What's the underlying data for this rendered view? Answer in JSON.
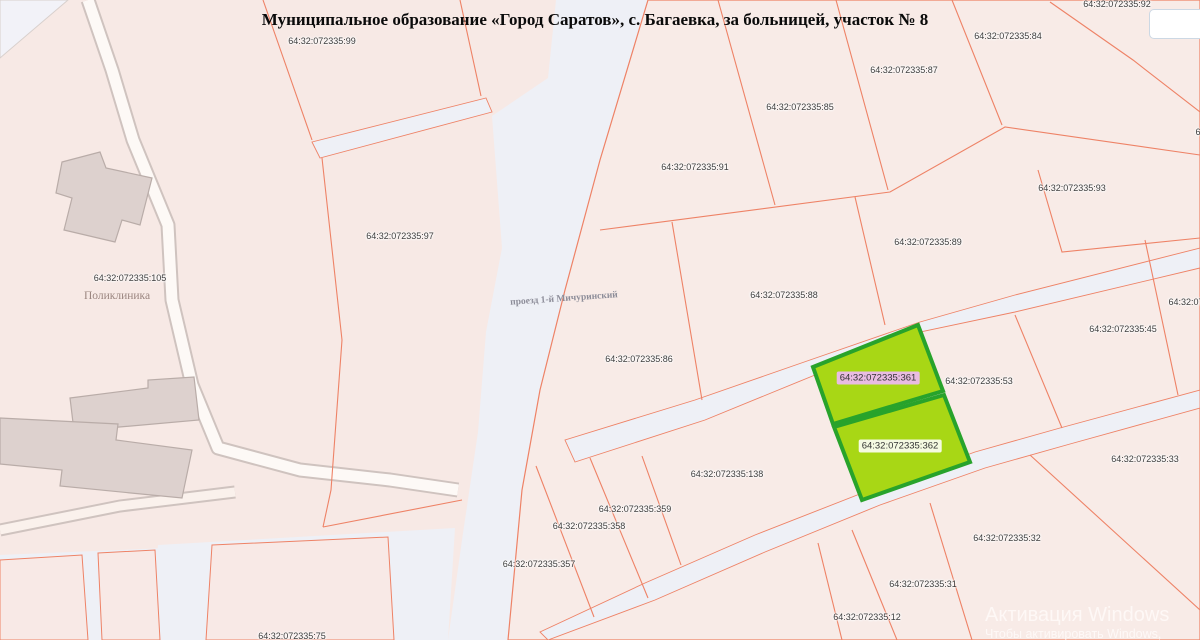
{
  "title": "Муниципальное образование «Город Саратов», с. Багаевка, за больницей, участок № 8",
  "map": {
    "parcel_labels": [
      {
        "text": "64:32:072335:92",
        "x": 1117,
        "y": 5
      },
      {
        "text": "64:32:072335:84",
        "x": 1008,
        "y": 37
      },
      {
        "text": "64:32:072335:87",
        "x": 904,
        "y": 71
      },
      {
        "text": "64:32:072335:85",
        "x": 800,
        "y": 108
      },
      {
        "text": "64:32:072335:91",
        "x": 695,
        "y": 168
      },
      {
        "text": "64:32:072335:93",
        "x": 1072,
        "y": 189
      },
      {
        "text": "64:32:072335:89",
        "x": 928,
        "y": 243
      },
      {
        "text": "64:32:072335:88",
        "x": 784,
        "y": 296
      },
      {
        "text": "64:32:072335:86",
        "x": 639,
        "y": 360
      },
      {
        "text": "64:32:072335:45",
        "x": 1123,
        "y": 330
      },
      {
        "text": "64:32:072335:53",
        "x": 979,
        "y": 382
      },
      {
        "text": "64:32:072335:33",
        "x": 1145,
        "y": 460
      },
      {
        "text": "64:32:072335:138",
        "x": 727,
        "y": 475
      },
      {
        "text": "64:32:072335:359",
        "x": 635,
        "y": 510
      },
      {
        "text": "64:32:072335:358",
        "x": 589,
        "y": 527
      },
      {
        "text": "64:32:072335:357",
        "x": 539,
        "y": 565
      },
      {
        "text": "64:32:072335:32",
        "x": 1007,
        "y": 539
      },
      {
        "text": "64:32:072335:31",
        "x": 923,
        "y": 585
      },
      {
        "text": "64:32:072335:12",
        "x": 867,
        "y": 618
      },
      {
        "text": "64:32:072335:99",
        "x": 322,
        "y": 42
      },
      {
        "text": "64:32:072335:97",
        "x": 400,
        "y": 237
      },
      {
        "text": "64:32:072335:105",
        "x": 130,
        "y": 279
      },
      {
        "text": "64:32:072335:75",
        "x": 292,
        "y": 637
      },
      {
        "text": "64:32:072335",
        "x": 1196,
        "y": 303
      },
      {
        "text": "64:32:07",
        "x": 1213,
        "y": 133
      }
    ],
    "highlight_labels": [
      {
        "text": "64:32:072335:361",
        "x": 878,
        "y": 378,
        "bg": "#e9bce2"
      },
      {
        "text": "64:32:072335:362",
        "x": 900,
        "y": 446,
        "bg": "rgba(255,255,255,0.88)"
      }
    ],
    "place_labels": [
      {
        "text": "Поликлиника",
        "x": 117,
        "y": 296
      }
    ],
    "road_label": {
      "text": "проезд 1-й Мичуринский",
      "x": 564,
      "y": 299
    }
  },
  "watermark": {
    "line1": "Активация Windows",
    "line2": "Чтобы активировать Windows, перейдите"
  },
  "colors": {
    "background_road": "#eef0f6",
    "quarter_fill": "#f7e9e5",
    "parcel_border": "#ee8266",
    "highlight_fill": "#a8d715",
    "highlight_border": "#28a32b",
    "building_fill": "#ddd1ce",
    "building_border": "#b9aca8",
    "selected_label_bg": "#e9bce2"
  }
}
